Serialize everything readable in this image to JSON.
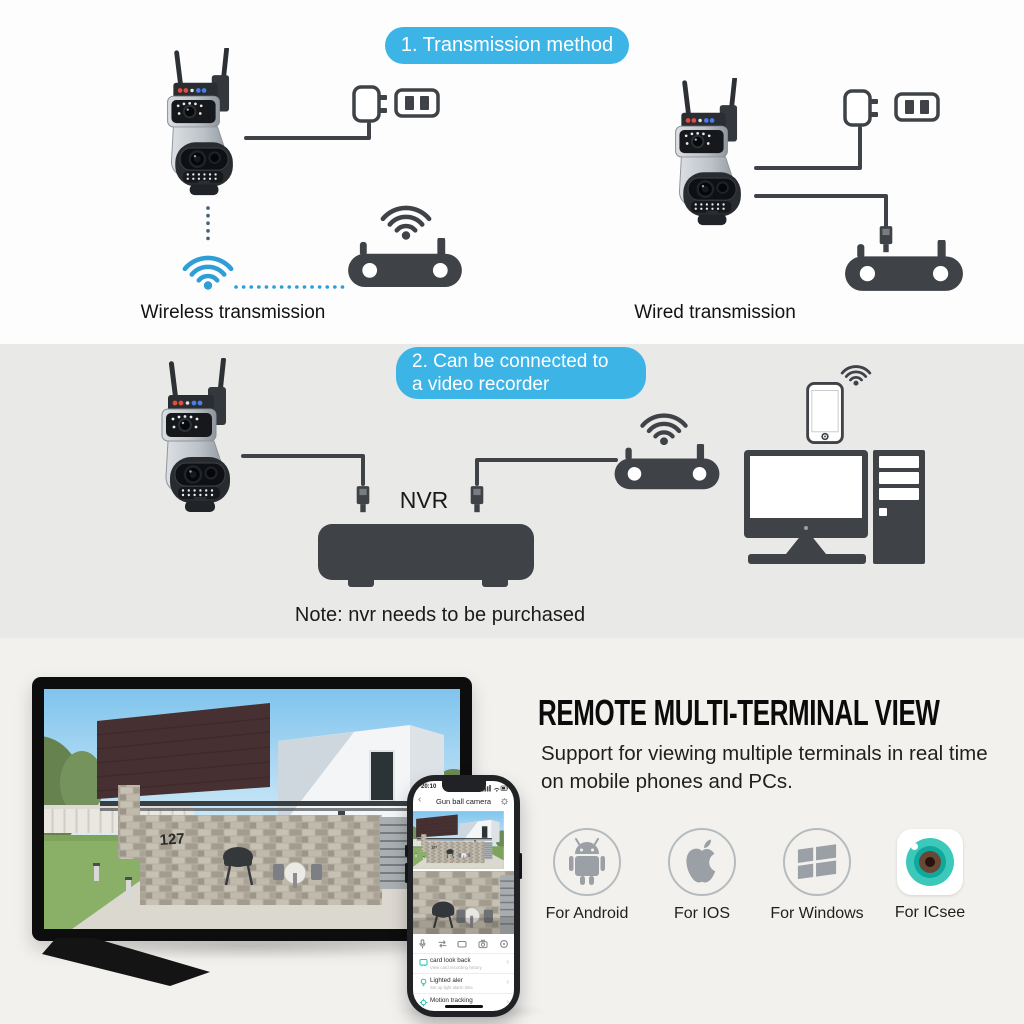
{
  "colors": {
    "banner_blue": "#3db4e6",
    "wifi_blue": "#2e9fd6",
    "device_dark": "#3f4347",
    "dotted_gray": "#486071",
    "section1_bg": "#fdfdfd",
    "section2_bg": "#e9e9e8",
    "section3_bg": "#f2f1ee",
    "app_teal": "#2cc0b4",
    "icsee_teal": "#3cc9bc",
    "platform_gray": "#9aa0a5",
    "heading_black": "#0b0b0b"
  },
  "icons": {
    "back": "‹",
    "chevron": "›"
  },
  "section1": {
    "banner": "1. Transmission method",
    "wireless_caption": "Wireless transmission",
    "wired_caption": "Wired transmission"
  },
  "section2": {
    "banner_line1": "2. Can be connected to",
    "banner_line2": "a video recorder",
    "nvr_label": "NVR",
    "note": "Note: nvr needs to be purchased"
  },
  "section3": {
    "heading": "REMOTE MULTI-TERMINAL VIEW",
    "subheading": "Support for viewing multiple terminals in real time on mobile phones and PCs.",
    "platforms": [
      {
        "label": "For Android"
      },
      {
        "label": "For IOS"
      },
      {
        "label": "For Windows"
      },
      {
        "label": "For ICsee"
      }
    ],
    "tv": {
      "house_number": "127"
    },
    "phone": {
      "status_time": "20:10",
      "title": "Gun ball camera",
      "list": [
        {
          "label": "card look back",
          "sub": "View card recording history"
        },
        {
          "label": "Lighted aler",
          "sub": "Set up light alarm time"
        },
        {
          "label": "Motion tracking",
          "sub": ""
        }
      ]
    }
  }
}
